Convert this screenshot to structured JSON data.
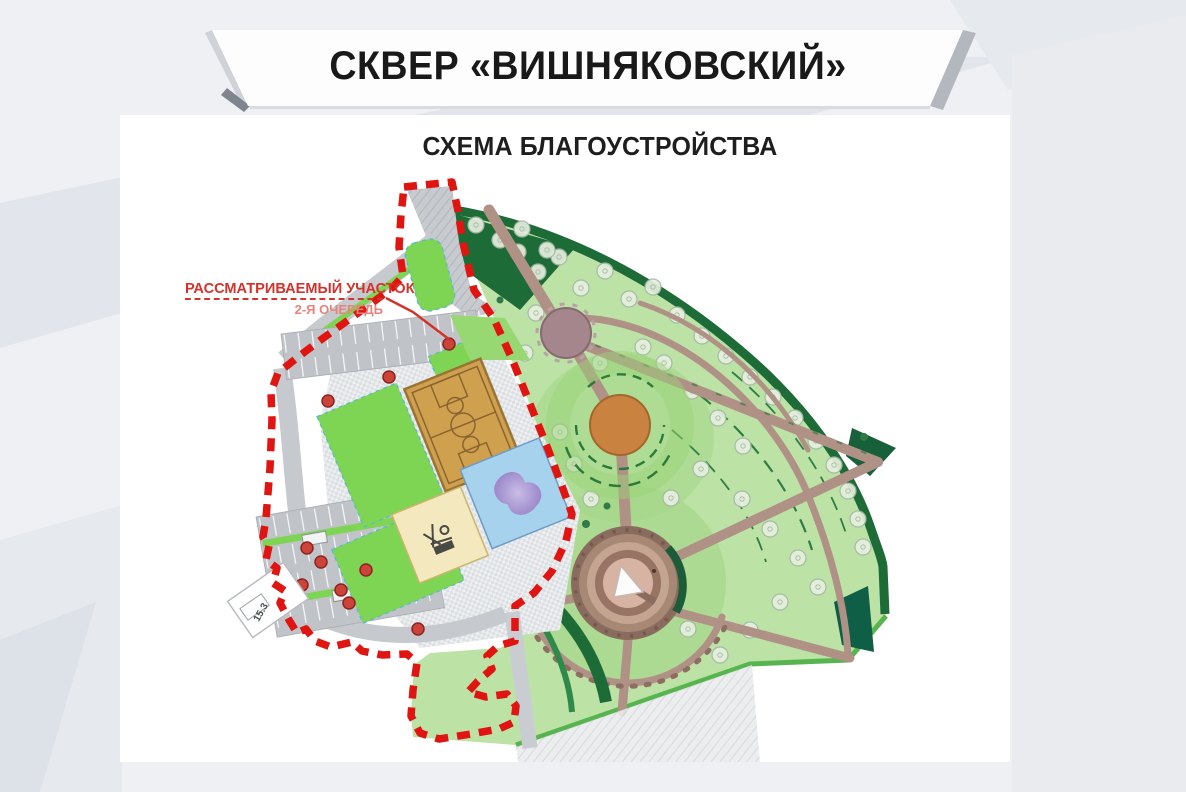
{
  "slide": {
    "title": "СКВЕР  «ВИШНЯКОВСКИЙ»",
    "subtitle": "СХЕМА БЛАГОУСТРОЙСТВА"
  },
  "callout": {
    "line1": "РАССМАТРИВАЕМЫЙ УЧАСТОК",
    "line2": "2-Я ОЧЕРЕДЬ"
  },
  "map": {
    "building_label": "15.3",
    "colors": {
      "boundary_red": "#e01410",
      "callout_red": "#d4322a",
      "callout_red_light": "#e5847c",
      "lawn_light": "#bce2a6",
      "lawn_bright": "#7ed453",
      "forest_dark_green": "#1d6b36",
      "path_brown": "#b09186",
      "plaza_mauve": "#a5868c",
      "plaza_orange": "#c9823f",
      "court_tan": "#cfa04e",
      "pool_blue": "#a6d2ee",
      "water_feature_purple": "#b098d2",
      "paving_gray": "#c6c9cd",
      "banner_white": "#fdfdfe"
    }
  }
}
